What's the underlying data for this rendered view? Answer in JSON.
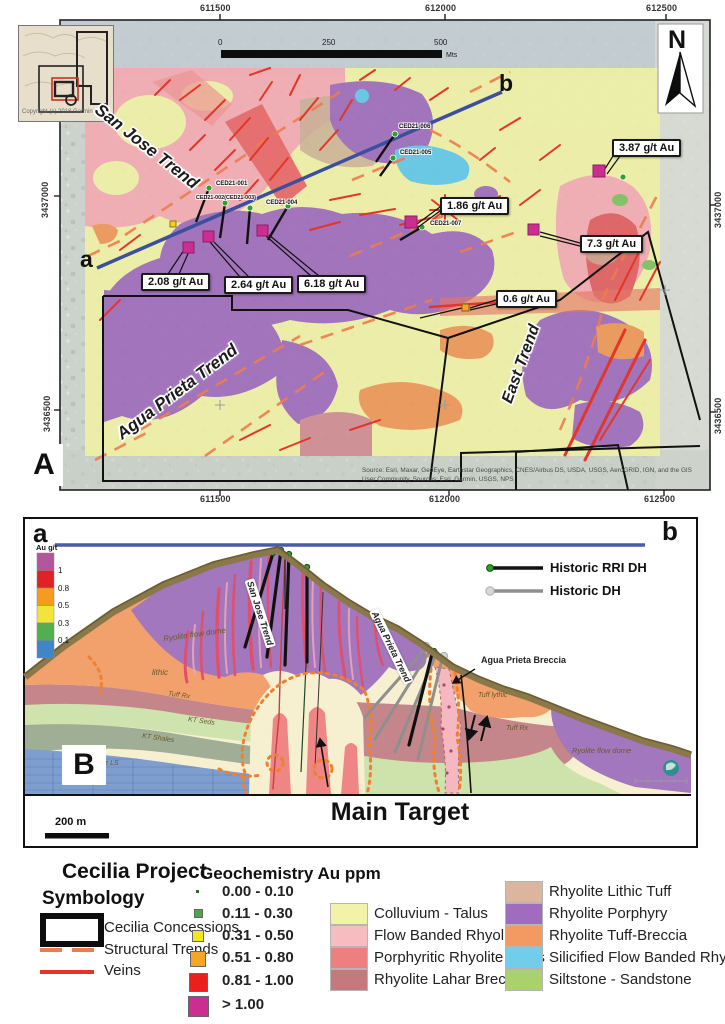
{
  "panelA": {
    "label": "A",
    "north": "N",
    "inset_copyright": "Copyright (c) 2018 Garmin",
    "scalebar": {
      "zero": "0",
      "mid": "250",
      "max": "500",
      "unit": "Mts"
    },
    "coords": {
      "top": [
        "611500",
        "612000",
        "612500"
      ],
      "bottom": [
        "611500",
        "612000",
        "612500"
      ],
      "left": [
        "3437000",
        "3436500"
      ],
      "right": [
        "3437000",
        "3436500"
      ]
    },
    "section_line": {
      "start": "a",
      "end": "b"
    },
    "trends": [
      {
        "name": "San Jose Trend"
      },
      {
        "name": "Agua Prieta Trend"
      },
      {
        "name": "East Trend"
      }
    ],
    "drillholes": [
      {
        "id": "CED21-001"
      },
      {
        "id": "CED21-002(CED21-003)"
      },
      {
        "id": "CED21-004"
      },
      {
        "id": "CED21-006"
      },
      {
        "id": "CED21-005"
      },
      {
        "id": "CED21-007"
      }
    ],
    "assays": [
      {
        "value": "2.08 g/t Au"
      },
      {
        "value": "2.64 g/t Au"
      },
      {
        "value": "6.18 g/t Au"
      },
      {
        "value": "1.86 g/t Au"
      },
      {
        "value": "3.87 g/t Au"
      },
      {
        "value": "7.3 g/t Au"
      },
      {
        "value": "0.6 g/t Au"
      }
    ],
    "source": "Source: Esri, Maxar, GeoEye, Earthstar Geographics, CNES/Airbus DS, USDA, USGS, AeroGRID, IGN, and the GIS User Community, Sources: Esri, Garmin, USGS, NPS"
  },
  "panelB": {
    "label": "B",
    "section_line": {
      "start": "a",
      "end": "b"
    },
    "au_scale": {
      "title": "Au g/t",
      "ticks": [
        "1",
        "0.8",
        "0.5",
        "0.3",
        "0.1"
      ],
      "colors": [
        "#b4569b",
        "#e02125",
        "#f59b1e",
        "#f2e43b",
        "#53ae4f",
        "#3f86c6"
      ]
    },
    "dh_legend": [
      {
        "label": "Historic RRI DH"
      },
      {
        "label": "Historic DH"
      }
    ],
    "unit_labels": {
      "ryolite_flow_dome_left": "Ryolite flow dome",
      "lithic": "lithic",
      "tuff_rx_left": "Tuff Rx",
      "kt_seds": "KT Seds",
      "kt_shales": "KT Shales",
      "pz_ls": "Pz LS",
      "tuff_lythic": "Tuff lythic",
      "tuff_bx": "Tuff Rx",
      "ryolite_flow_dome_right": "Ryolite flow dome"
    },
    "trend_labels": {
      "san_jose": "San Jose Trend",
      "agua_prieta": "Agua Prieta Trend"
    },
    "annotations": {
      "agua_prieta_breccia": "Agua Prieta Breccia",
      "main_target": "Main Target"
    },
    "scalebar": "200 m"
  },
  "legend": {
    "project_title": "Cecilia Project",
    "symbology_title": "Symbology",
    "symbology": [
      {
        "label": "Cecilia Concessions"
      },
      {
        "label": "Structural Trends"
      },
      {
        "label": "Veins"
      }
    ],
    "geochem_title": "Geochemistry Au ppm",
    "geochem_classes": [
      {
        "range": "0.00 - 0.10",
        "color": "#2e6b2e"
      },
      {
        "range": "0.11 - 0.30",
        "color": "#4ca64c"
      },
      {
        "range": "0.31 - 0.50",
        "color": "#f5e51f"
      },
      {
        "range": "0.51 - 0.80",
        "color": "#f5a623"
      },
      {
        "range": "0.81 - 1.00",
        "color": "#e8211d"
      },
      {
        "range": "> 1.00",
        "color": "#cb2d90"
      }
    ],
    "geology_units": [
      {
        "name": "Colluvium - Talus",
        "color": "#f2f2a8"
      },
      {
        "name": "Flow Banded Rhyolite",
        "color": "#f6bcc0"
      },
      {
        "name": "Porphyritic Rhyolite Dikes",
        "color": "#ee7f80"
      },
      {
        "name": "Rhyolite Lahar Breccia",
        "color": "#c4797d"
      },
      {
        "name": "Rhyolite Lithic Tuff",
        "color": "#dcb69c"
      },
      {
        "name": "Rhyolite Porphyry",
        "color": "#a06cc0"
      },
      {
        "name": "Rhyolite Tuff-Breccia",
        "color": "#f29a62"
      },
      {
        "name": "Silicified Flow Banded Rhyolite",
        "color": "#72cdea"
      },
      {
        "name": "Siltstone - Sandstone",
        "color": "#a9d16e"
      }
    ]
  }
}
